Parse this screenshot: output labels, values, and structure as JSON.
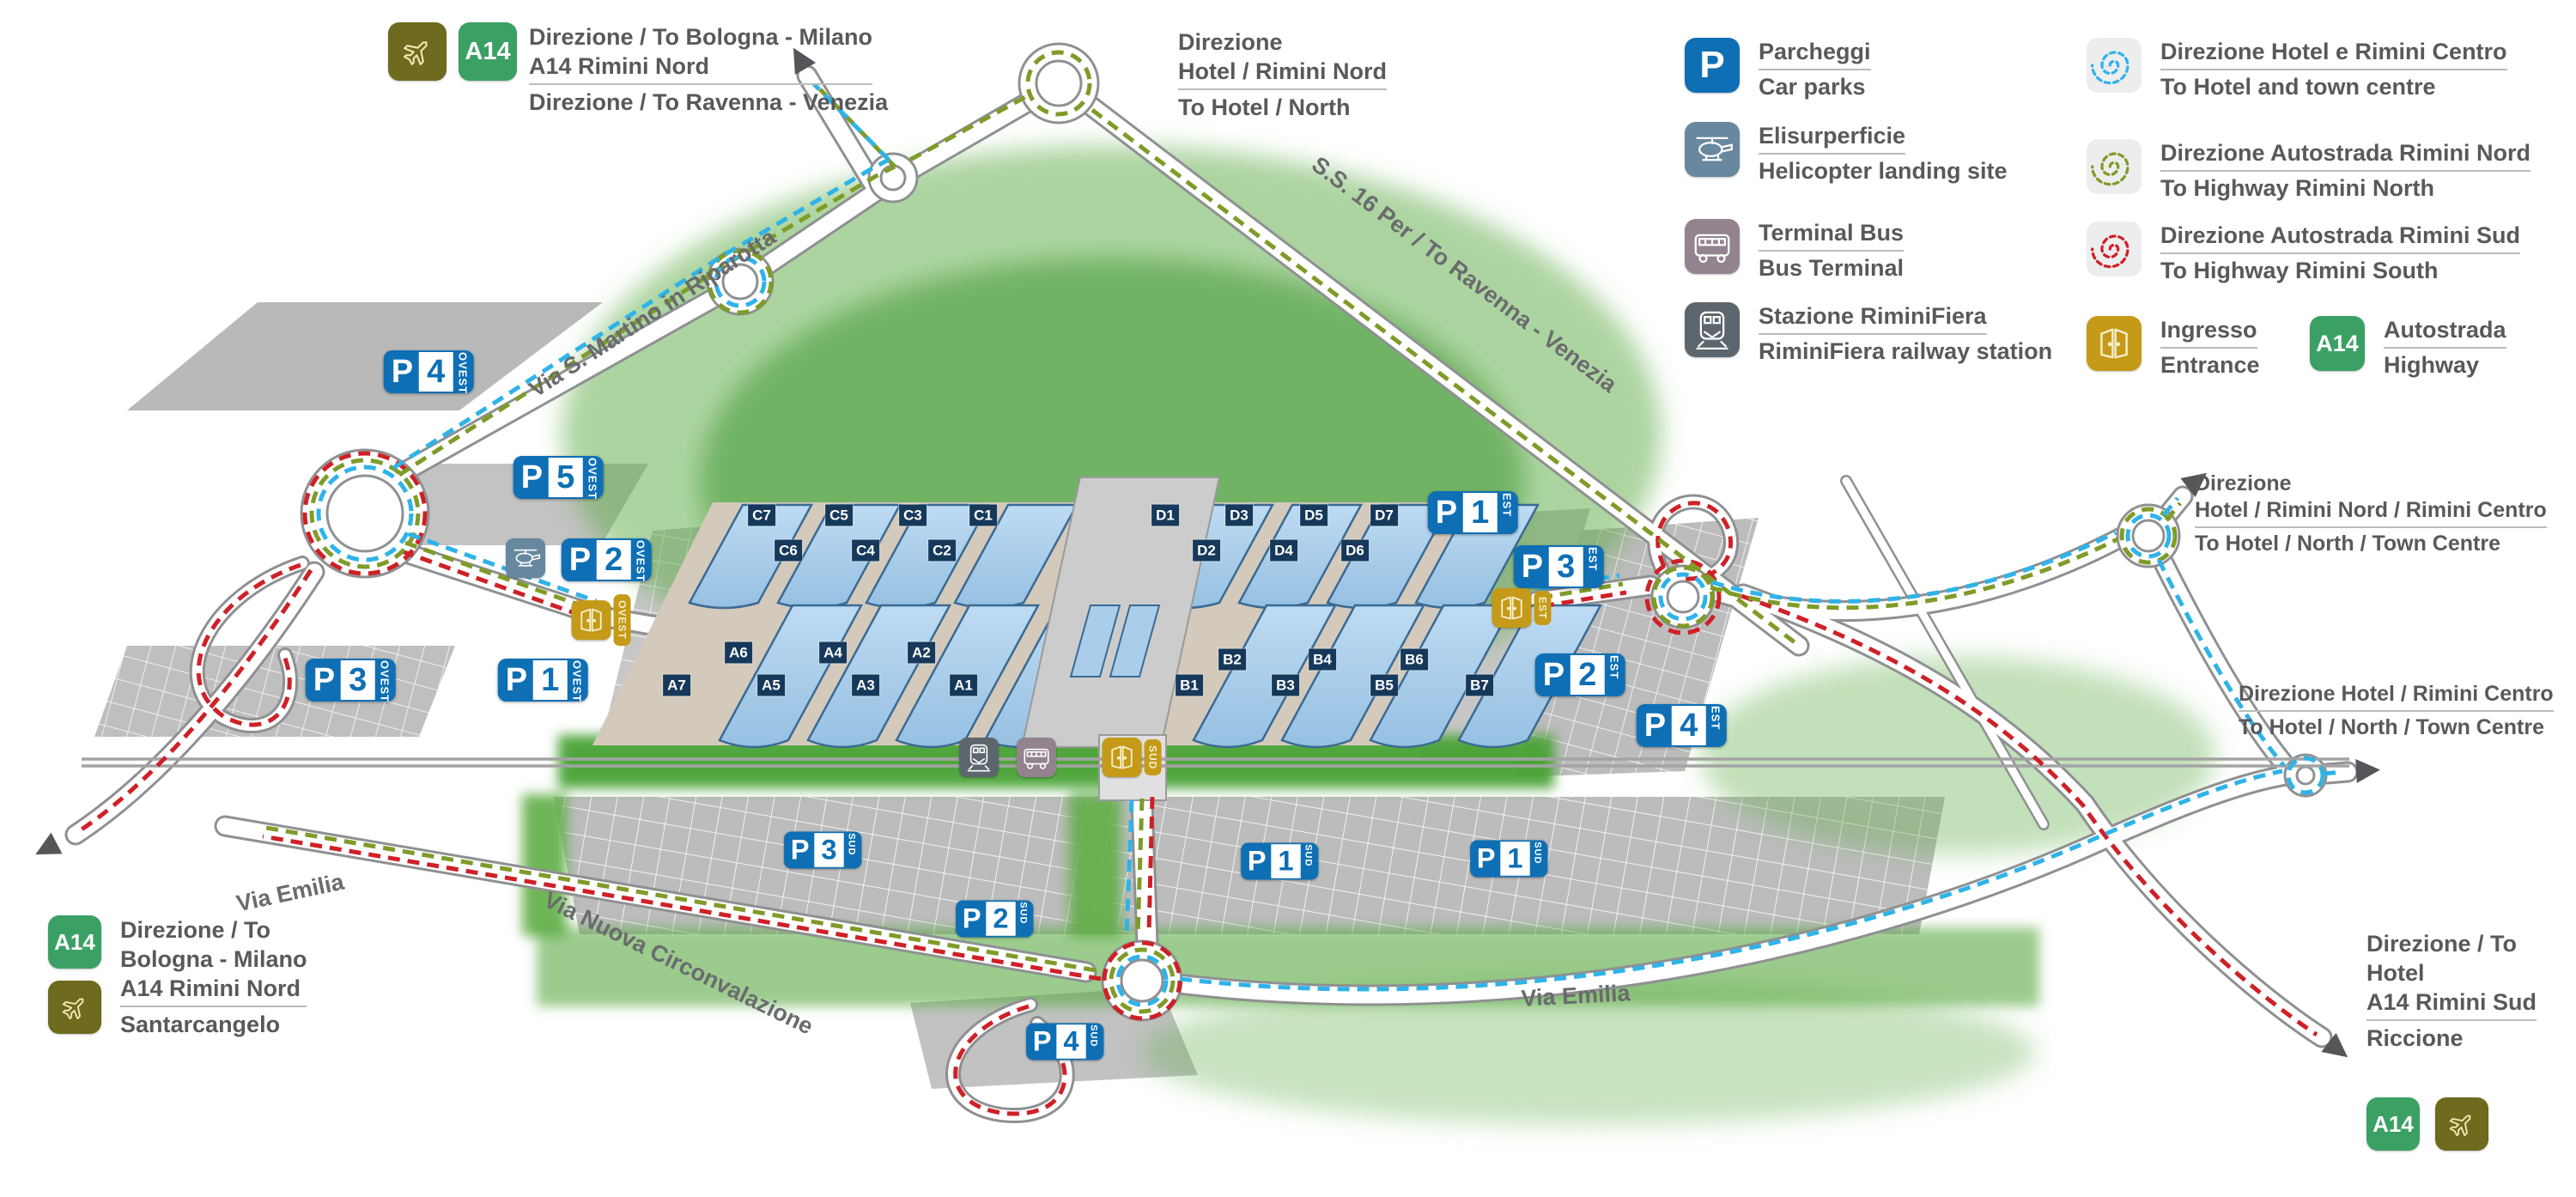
{
  "signs": {
    "p": "P",
    "a14": "A14",
    "parking": [
      {
        "num": "4",
        "area": "OVEST"
      },
      {
        "num": "5",
        "area": "OVEST"
      },
      {
        "num": "2",
        "area": "OVEST"
      },
      {
        "num": "3",
        "area": "OVEST"
      },
      {
        "num": "1",
        "area": "OVEST"
      },
      {
        "num": "1",
        "area": "EST"
      },
      {
        "num": "3",
        "area": "EST"
      },
      {
        "num": "2",
        "area": "EST"
      },
      {
        "num": "4",
        "area": "EST"
      },
      {
        "num": "3",
        "area": "SUD"
      },
      {
        "num": "2",
        "area": "SUD"
      },
      {
        "num": "1",
        "area": "SUD"
      },
      {
        "num": "1",
        "area": "SUD"
      },
      {
        "num": "4",
        "area": "SUD"
      }
    ],
    "entrances": [
      {
        "area": "OVEST"
      },
      {
        "area": "EST"
      },
      {
        "area": "SUD"
      }
    ]
  },
  "halls": {
    "c": [
      "C7",
      "C6",
      "C5",
      "C4",
      "C3",
      "C2",
      "C1"
    ],
    "d": [
      "D1",
      "D2",
      "D3",
      "D4",
      "D5",
      "D6",
      "D7"
    ],
    "a": [
      "A7",
      "A6",
      "A5",
      "A4",
      "A3",
      "A2",
      "A1"
    ],
    "b": [
      "B1",
      "B2",
      "B3",
      "B4",
      "B5",
      "B6",
      "B7"
    ]
  },
  "legend": {
    "services": [
      {
        "icon": "parking-icon",
        "it": "Parcheggi",
        "en": "Car parks"
      },
      {
        "icon": "helicopter-icon",
        "it": "Elisurperficie",
        "en": "Helicopter landing site"
      },
      {
        "icon": "bus-icon",
        "it": "Terminal Bus",
        "en": "Bus Terminal"
      },
      {
        "icon": "train-icon",
        "it": "Stazione RiminiFiera",
        "en": "RiminiFiera railway station"
      }
    ],
    "directions": [
      {
        "icon": "spiral-cyan-icon",
        "it": "Direzione Hotel e Rimini Centro",
        "en": "To Hotel and town centre"
      },
      {
        "icon": "spiral-green-icon",
        "it": "Direzione Autostrada Rimini Nord",
        "en": "To Highway Rimini North"
      },
      {
        "icon": "spiral-red-icon",
        "it": "Direzione Autostrada Rimini Sud",
        "en": "To Highway Rimini South"
      }
    ],
    "entrance": {
      "it": "Ingresso",
      "en": "Entrance"
    },
    "highway": {
      "it": "Autostrada",
      "en": "Highway"
    }
  },
  "dir": {
    "top_left": {
      "l1": "Direzione / To Bologna - Milano",
      "l2": "A14 Rimini Nord",
      "l3": "Direzione / To Ravenna - Venezia"
    },
    "top_center": {
      "l1": "Direzione",
      "l2": "Hotel / Rimini Nord",
      "l3": "To Hotel / North"
    },
    "right_upper": {
      "l1": "Direzione",
      "l2": "Hotel / Rimini Nord / Rimini Centro",
      "l3": "To Hotel / North / Town Centre"
    },
    "right_mid": {
      "l1": "Direzione Hotel / Rimini  Centro",
      "l2": "To Hotel / North / Town Centre"
    },
    "bottom_left": {
      "l1": "Direzione / To",
      "l2": "Bologna - Milano",
      "l3": "A14 Rimini Nord",
      "l4": "Santarcangelo"
    },
    "bottom_right": {
      "l1": "Direzione / To",
      "l2": "Hotel",
      "l3": "A14 Rimini Sud",
      "l4": "Riccione"
    }
  },
  "roads": {
    "via_s_martino": "Via S. Martino in Riparotta",
    "ss16": "S.S. 16 Per / To Ravenna - Venezia",
    "via_emilia_w": "Via Emilia",
    "via_nuova": "Via Nuova Circonvalazione",
    "via_emilia_e": "Via Emilia"
  },
  "colors": {
    "route_hotel_centre": "#2fb3e8",
    "route_highway_north": "#7f9b28",
    "route_highway_south": "#cf2027",
    "parking_blue": "#0e6fb5",
    "entrance_gold": "#c49a18",
    "a14_green": "#3ba064",
    "hall_blue": "#a9cdea",
    "hall_label_navy": "#16395b"
  }
}
